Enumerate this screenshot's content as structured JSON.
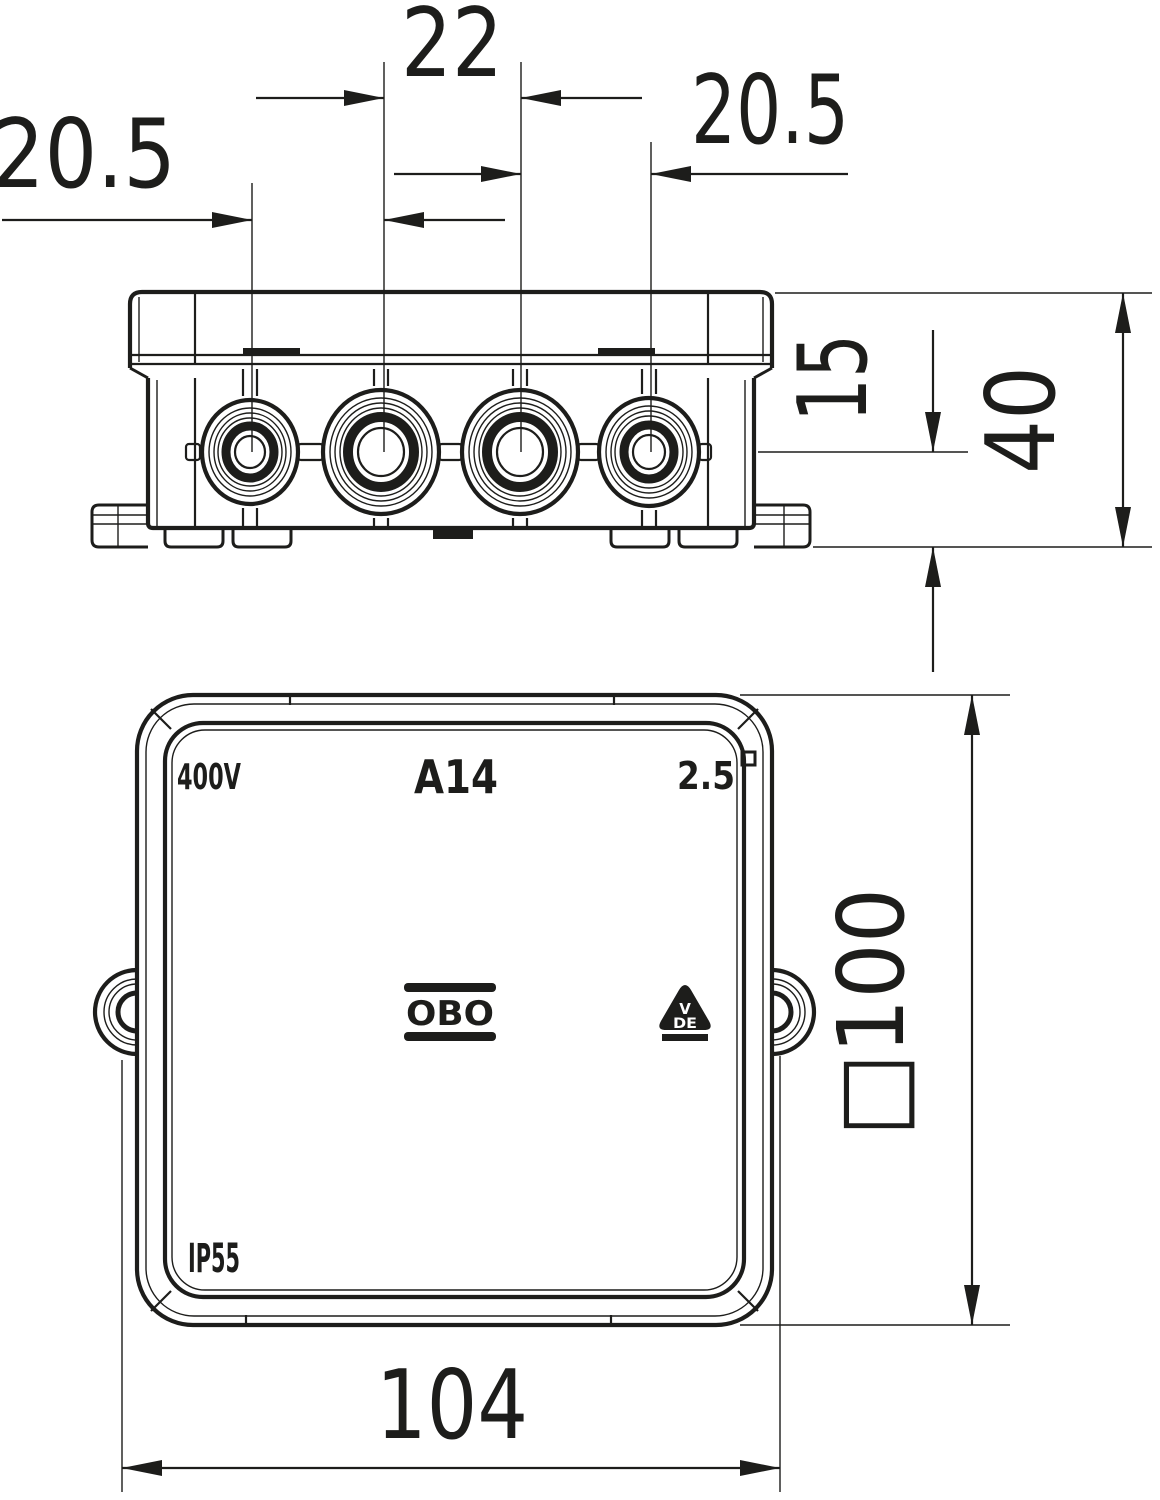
{
  "drawing": {
    "type": "technical-dimension-drawing",
    "background": "#ffffff",
    "line_color": "#1d1d1b",
    "views": {
      "side_view": "junction box side elevation with 4 cable entry glands",
      "front_view": "junction box front face with mounting ears"
    },
    "dimensions": {
      "top_left_spacing": "20.5",
      "top_center_spacing": "22",
      "top_right_spacing": "20.5",
      "gland_axis_height": "15",
      "box_depth": "40",
      "face_square_size": "□100",
      "overall_width": "104"
    },
    "markings": {
      "voltage": "400V",
      "model": "A14",
      "conductor_size": "2.5",
      "protection_rating": "IP55",
      "brand": "OBO",
      "cert_line1": "V",
      "cert_line2": "DE"
    }
  }
}
